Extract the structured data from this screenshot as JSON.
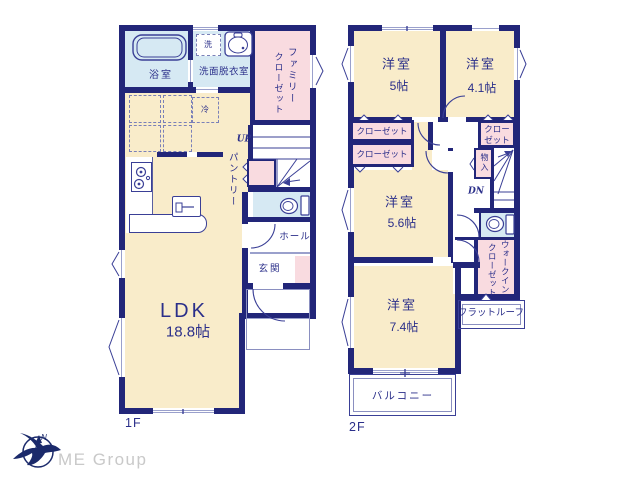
{
  "colors": {
    "wall_navy": "#222679",
    "room_cream": "#f9ecca",
    "closet_pink": "#f9dbe0",
    "wet_area_blue": "#d6e9f3",
    "text_navy": "#2b2f8a",
    "logo_gray": "#c9c9c9"
  },
  "floor1": {
    "floor_label": "1F",
    "bath": "浴室",
    "laundry": "洗",
    "washroom": "洗面脱衣室",
    "family_closet_line1": "ファミリー",
    "family_closet_line2": "クローゼット",
    "fridge": "冷",
    "stairs_up": "UP",
    "pantry": "パントリー",
    "hall": "ホール",
    "entrance": "玄関",
    "ldk_name": "LDK",
    "ldk_size": "18.8帖"
  },
  "floor2": {
    "floor_label": "2F",
    "bedroom1_name": "洋室",
    "bedroom1_size": "5帖",
    "bedroom2_name": "洋室",
    "bedroom2_size": "4.1帖",
    "closet_left1": "クローゼット",
    "closet_left2": "クローゼット",
    "closet_right_line1": "クロー",
    "closet_right_line2": "ゼット",
    "storage": "物入",
    "stairs_down": "DN",
    "bedroom3_name": "洋室",
    "bedroom3_size": "5.6帖",
    "wic_line1": "ウォークイン",
    "wic_line2": "クローゼット",
    "bedroom4_name": "洋室",
    "bedroom4_size": "7.4帖",
    "flat_roof": "フラットルーフ",
    "balcony": "バルコニー"
  },
  "logo": {
    "company": "ME Group",
    "compass": "N"
  }
}
